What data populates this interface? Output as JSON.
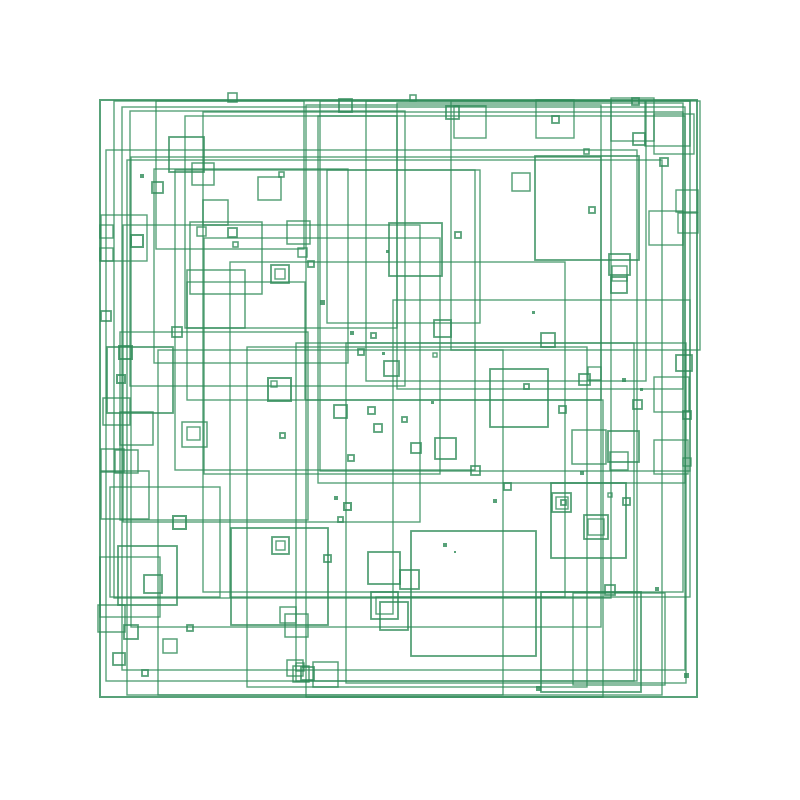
{
  "canvas": {
    "width": 800,
    "height": 800,
    "background": "#ffffff"
  },
  "artwork": {
    "description": "Generative pattern of overlapping green square outlines on a white background, bounded by one large outer square. Each square: [x, y, side, stroke_width, filled_flag].",
    "stroke_color": "#2E8B57",
    "stroke_opacity": 0.8,
    "fill": "none",
    "squares": [
      [
        100,
        100,
        597,
        2,
        0
      ],
      [
        114,
        101,
        497,
        1.4,
        0
      ],
      [
        122,
        107,
        563,
        1.4,
        0
      ],
      [
        130,
        111,
        275,
        1.4,
        0
      ],
      [
        131,
        157,
        470,
        1.4,
        0
      ],
      [
        185,
        116,
        212,
        1.4,
        0
      ],
      [
        204,
        238,
        236,
        1.4,
        0
      ],
      [
        230,
        262,
        335,
        1.4,
        0
      ],
      [
        247,
        347,
        340,
        1.4,
        0
      ],
      [
        306,
        105,
        295,
        1.4,
        0
      ],
      [
        306,
        400,
        297,
        1.4,
        0
      ],
      [
        320,
        101,
        370,
        1.4,
        0
      ],
      [
        318,
        116,
        367,
        1.4,
        0
      ],
      [
        154,
        169,
        194,
        1.4,
        0
      ],
      [
        296,
        343,
        338,
        1.4,
        0
      ],
      [
        327,
        170,
        153,
        1.4,
        0
      ],
      [
        203,
        112,
        480,
        1.4,
        0
      ],
      [
        366,
        101,
        280,
        1.4,
        0
      ],
      [
        156,
        101,
        148,
        1.4,
        0
      ],
      [
        106,
        150,
        531,
        1.4,
        0
      ],
      [
        110,
        487,
        110,
        1.4,
        0
      ],
      [
        120,
        332,
        188,
        1.4,
        0
      ],
      [
        346,
        343,
        340,
        1.4,
        0
      ],
      [
        451,
        101,
        249,
        1.4,
        0
      ],
      [
        175,
        170,
        300,
        1.4,
        0
      ],
      [
        397,
        103,
        286,
        1.4,
        0
      ],
      [
        393,
        300,
        297,
        1.4,
        0
      ],
      [
        123,
        225,
        297,
        1.4,
        0
      ],
      [
        187,
        282,
        118,
        1.4,
        0
      ],
      [
        158,
        350,
        345,
        1.4,
        0
      ],
      [
        127,
        160,
        535,
        1.4,
        0
      ],
      [
        100,
        557,
        60,
        1.4,
        0
      ],
      [
        101,
        215,
        46,
        1.4,
        0
      ],
      [
        645,
        101,
        45,
        1.4,
        0
      ],
      [
        611,
        98,
        43,
        1.4,
        0
      ],
      [
        536,
        100,
        38,
        1.4,
        0
      ],
      [
        654,
        114,
        40,
        1.4,
        0
      ],
      [
        649,
        211,
        34,
        1.4,
        0
      ],
      [
        454,
        106,
        32,
        1.4,
        0
      ],
      [
        676,
        190,
        22,
        1.4,
        0
      ],
      [
        678,
        213,
        20,
        1.4,
        0
      ],
      [
        535,
        156,
        104,
        1.8,
        0
      ],
      [
        169,
        137,
        35,
        1.8,
        0
      ],
      [
        192,
        163,
        22,
        1.5,
        0
      ],
      [
        152,
        182,
        11,
        1.8,
        0
      ],
      [
        258,
        177,
        23,
        1.5,
        0
      ],
      [
        203,
        200,
        25,
        1.5,
        0
      ],
      [
        190,
        222,
        72,
        1.5,
        0
      ],
      [
        187,
        270,
        58,
        1.5,
        0
      ],
      [
        271,
        265,
        18,
        1.8,
        0
      ],
      [
        275,
        269,
        10,
        1.4,
        0
      ],
      [
        131,
        235,
        12,
        2,
        0
      ],
      [
        287,
        221,
        23,
        1.5,
        0
      ],
      [
        389,
        223,
        53,
        1.8,
        0
      ],
      [
        512,
        173,
        18,
        1.5,
        0
      ],
      [
        633,
        133,
        12,
        1.8,
        0
      ],
      [
        660,
        158,
        8,
        1.8,
        0
      ],
      [
        609,
        254,
        21,
        1.8,
        0
      ],
      [
        612,
        266,
        15,
        1.4,
        0
      ],
      [
        611,
        277,
        16,
        1.8,
        0
      ],
      [
        107,
        347,
        66,
        1.8,
        0
      ],
      [
        119,
        346,
        13,
        2,
        0
      ],
      [
        103,
        398,
        27,
        1.5,
        0
      ],
      [
        120,
        412,
        33,
        1.5,
        0
      ],
      [
        182,
        422,
        25,
        1.5,
        0
      ],
      [
        187,
        427,
        13,
        1.4,
        0
      ],
      [
        268,
        378,
        23,
        2,
        0
      ],
      [
        271,
        381,
        6,
        1.4,
        0
      ],
      [
        101,
        449,
        23,
        1.5,
        0
      ],
      [
        115,
        450,
        23,
        1.5,
        0
      ],
      [
        101,
        471,
        48,
        1.5,
        0
      ],
      [
        101,
        311,
        10,
        1.8,
        0
      ],
      [
        100,
        225,
        13,
        1.4,
        0
      ],
      [
        172,
        327,
        10,
        1.8,
        0
      ],
      [
        490,
        369,
        58,
        1.8,
        0
      ],
      [
        434,
        320,
        17,
        1.8,
        0
      ],
      [
        541,
        333,
        14,
        1.8,
        0
      ],
      [
        384,
        361,
        15,
        1.8,
        0
      ],
      [
        334,
        405,
        13,
        1.8,
        0
      ],
      [
        435,
        438,
        21,
        1.8,
        0
      ],
      [
        411,
        443,
        10,
        1.8,
        0
      ],
      [
        471,
        466,
        9,
        1.8,
        0
      ],
      [
        572,
        430,
        34,
        1.5,
        0
      ],
      [
        608,
        431,
        31,
        1.8,
        0
      ],
      [
        610,
        452,
        18,
        1.5,
        0
      ],
      [
        683,
        411,
        8,
        1.8,
        0
      ],
      [
        683,
        458,
        8,
        1.4,
        0
      ],
      [
        676,
        355,
        16,
        1.8,
        0
      ],
      [
        654,
        377,
        35,
        1.4,
        0
      ],
      [
        654,
        440,
        34,
        1.4,
        0
      ],
      [
        552,
        493,
        19,
        1.8,
        0
      ],
      [
        556,
        497,
        12,
        1.4,
        0
      ],
      [
        561,
        500,
        5,
        1.8,
        0
      ],
      [
        584,
        515,
        24,
        1.8,
        0
      ],
      [
        588,
        519,
        16,
        1.4,
        0
      ],
      [
        368,
        552,
        32,
        1.8,
        0
      ],
      [
        400,
        570,
        19,
        1.8,
        0
      ],
      [
        371,
        592,
        27,
        1.8,
        0
      ],
      [
        376,
        597,
        17,
        1.4,
        0
      ],
      [
        380,
        602,
        28,
        1.8,
        0
      ],
      [
        118,
        546,
        59,
        1.8,
        0
      ],
      [
        144,
        575,
        18,
        1.8,
        0
      ],
      [
        173,
        516,
        13,
        2,
        0
      ],
      [
        272,
        537,
        17,
        1.8,
        0
      ],
      [
        276,
        541,
        9,
        1.4,
        0
      ],
      [
        98,
        605,
        27,
        1.5,
        0
      ],
      [
        124,
        625,
        14,
        1.8,
        0
      ],
      [
        113,
        653,
        12,
        1.8,
        0
      ],
      [
        163,
        639,
        14,
        1.5,
        0
      ],
      [
        280,
        607,
        16,
        1.5,
        0
      ],
      [
        285,
        614,
        23,
        1.5,
        0
      ],
      [
        287,
        660,
        16,
        1.5,
        0
      ],
      [
        293,
        666,
        16,
        1.5,
        0
      ],
      [
        313,
        662,
        25,
        1.5,
        0
      ],
      [
        301,
        667,
        13,
        1.8,
        0
      ],
      [
        296,
        663,
        8,
        1.4,
        0
      ],
      [
        605,
        585,
        10,
        1.8,
        0
      ],
      [
        623,
        498,
        7,
        1.8,
        0
      ],
      [
        608,
        493,
        4,
        1.4,
        0
      ],
      [
        541,
        592,
        100,
        1.8,
        0
      ],
      [
        573,
        593,
        92,
        1.4,
        0
      ],
      [
        411,
        531,
        125,
        1.8,
        0
      ],
      [
        231,
        528,
        97,
        1.8,
        0
      ],
      [
        551,
        483,
        75,
        1.8,
        0
      ],
      [
        140,
        174,
        4,
        0,
        1
      ],
      [
        279,
        172,
        5,
        1.6,
        0
      ],
      [
        228,
        93,
        9,
        1.6,
        0
      ],
      [
        339,
        99,
        13,
        1.8,
        0
      ],
      [
        446,
        106,
        13,
        1.8,
        0
      ],
      [
        410,
        95,
        6,
        1.6,
        0
      ],
      [
        632,
        98,
        7,
        1.8,
        0
      ],
      [
        552,
        116,
        7,
        1.8,
        0
      ],
      [
        584,
        149,
        5,
        1.6,
        0
      ],
      [
        589,
        207,
        6,
        1.8,
        0
      ],
      [
        228,
        228,
        9,
        1.8,
        0
      ],
      [
        233,
        242,
        5,
        1.6,
        0
      ],
      [
        197,
        227,
        9,
        1.5,
        0
      ],
      [
        298,
        248,
        9,
        1.5,
        0
      ],
      [
        308,
        261,
        6,
        1.8,
        0
      ],
      [
        386,
        250,
        3,
        0,
        1
      ],
      [
        455,
        232,
        6,
        1.8,
        0
      ],
      [
        320,
        300,
        5,
        0,
        1
      ],
      [
        532,
        311,
        3,
        0,
        1
      ],
      [
        350,
        331,
        4,
        0,
        1
      ],
      [
        371,
        333,
        5,
        1.8,
        0
      ],
      [
        358,
        349,
        6,
        1.8,
        0
      ],
      [
        382,
        352,
        3,
        0,
        1
      ],
      [
        433,
        353,
        4,
        1.4,
        0
      ],
      [
        431,
        401,
        3,
        0,
        1
      ],
      [
        402,
        417,
        5,
        1.8,
        0
      ],
      [
        374,
        424,
        8,
        1.8,
        0
      ],
      [
        368,
        407,
        7,
        1.8,
        0
      ],
      [
        348,
        455,
        6,
        1.8,
        0
      ],
      [
        504,
        483,
        7,
        1.8,
        0
      ],
      [
        524,
        384,
        5,
        1.8,
        0
      ],
      [
        579,
        374,
        11,
        1.8,
        0
      ],
      [
        588,
        367,
        13,
        1.4,
        0
      ],
      [
        622,
        378,
        4,
        0,
        1
      ],
      [
        640,
        388,
        3,
        0,
        1
      ],
      [
        633,
        400,
        9,
        1.8,
        0
      ],
      [
        559,
        406,
        7,
        1.8,
        0
      ],
      [
        580,
        471,
        4,
        0,
        1
      ],
      [
        117,
        375,
        8,
        2,
        0
      ],
      [
        280,
        433,
        5,
        1.8,
        0
      ],
      [
        334,
        496,
        4,
        0,
        1
      ],
      [
        344,
        503,
        7,
        2,
        0
      ],
      [
        338,
        517,
        5,
        1.8,
        0
      ],
      [
        493,
        499,
        4,
        0,
        1
      ],
      [
        443,
        543,
        4,
        0,
        1
      ],
      [
        454,
        551,
        2,
        0,
        1
      ],
      [
        324,
        555,
        7,
        1.8,
        0
      ],
      [
        142,
        670,
        6,
        1.8,
        0
      ],
      [
        187,
        625,
        6,
        1.8,
        0
      ],
      [
        684,
        673,
        5,
        0,
        1
      ],
      [
        536,
        686,
        5,
        0,
        1
      ],
      [
        655,
        587,
        4,
        0,
        1
      ],
      [
        100,
        248,
        13,
        1.4,
        0
      ]
    ]
  }
}
